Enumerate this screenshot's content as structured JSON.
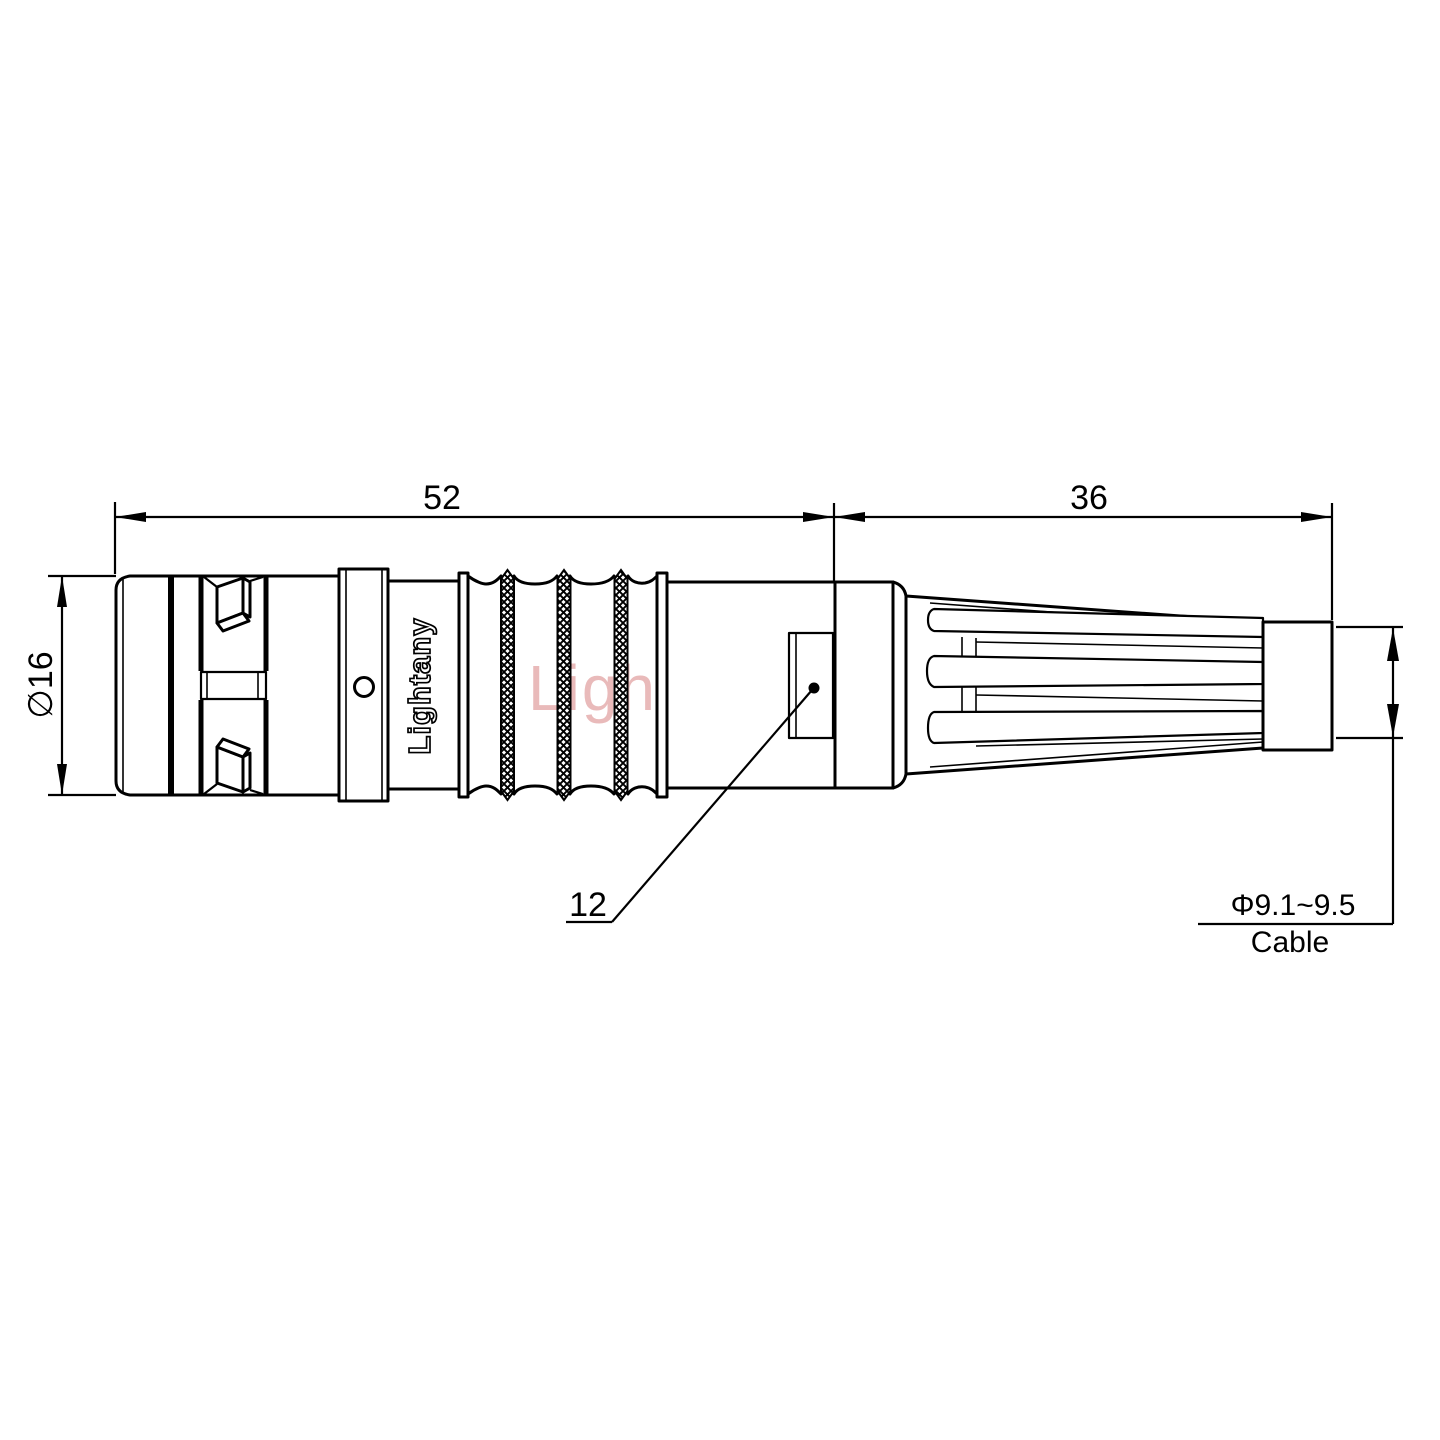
{
  "drawing_type": "connector-technical-drawing",
  "dimensions": {
    "front_length": "52",
    "rear_length": "36",
    "diameter": "∅16",
    "key_label": "12",
    "cable_diameter": "Φ9.1~9.5",
    "cable_label": "Cable"
  },
  "branding": {
    "body_text": "Lightany",
    "watermark_text": "Lightany",
    "watermark_color": "#e2a3a3"
  },
  "colors": {
    "line": "#000000",
    "background": "#ffffff"
  }
}
